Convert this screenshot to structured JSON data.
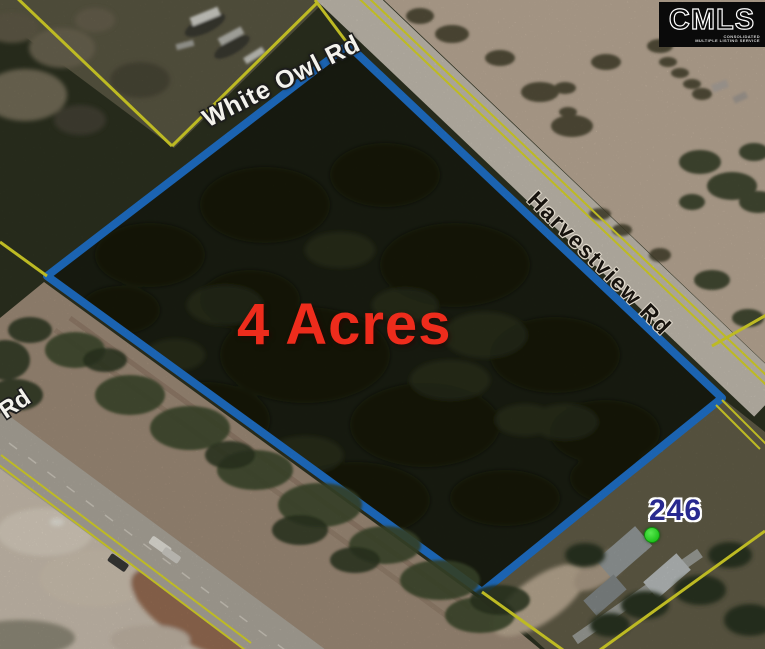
{
  "listing_map": {
    "acreage_text": "4 Acres",
    "parcel": {
      "number": "246"
    },
    "road_labels": {
      "white_owl": "White Owl Rd",
      "harvestview": "Harvestview Rd",
      "partial_left": "Rd"
    },
    "logo": {
      "title": "CMLS",
      "subtitle_line1": "CONSOLIDATED",
      "subtitle_line2": "MULTIPLE LISTING SERVICE"
    },
    "colors": {
      "parcel_outline_blue": "#2177d4",
      "boundary_yellow": "#e3df2b",
      "acreage_red": "#ee2c1c",
      "parcel_number_navy": "#28298f",
      "marker_green": "#2ed32b"
    }
  }
}
